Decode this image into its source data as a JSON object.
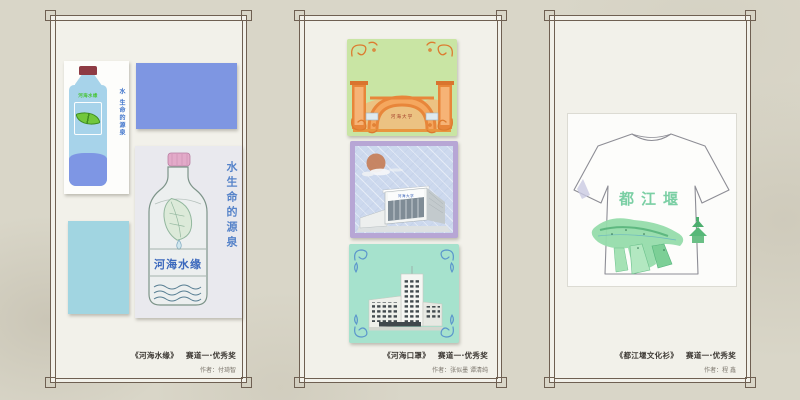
{
  "colors": {
    "page_background": "#d9d6c8",
    "frame_line": "#6f6052",
    "panel_background": "#f2f1ea",
    "cornflower_swatch": "#7e96e2",
    "cyan_swatch": "#a1d5e1",
    "mask1_background": "#c9e5a4",
    "mask1_accent": "#e8863a",
    "mask2_border": "#b7a6d5",
    "mask2_background": "#cdd9ee",
    "mask3_background": "#a6e2cd",
    "mask3_accent": "#5b96cc",
    "shirt_text_green": "#7bcfa4",
    "slogan_blue": "#3f74cc"
  },
  "panels": [
    {
      "name": "water-bottle-design",
      "caption": {
        "title": "《河海水缘》",
        "award": "赛道一·优秀奖",
        "author": "作者：付琦智"
      },
      "small_bottle": {
        "brand": "河海水缘",
        "slogan": "水 生命的源泉"
      },
      "big_bottle": {
        "brand": "河海水缘",
        "slogan": "水生命的源泉"
      }
    },
    {
      "name": "mask-design",
      "caption": {
        "title": "《河海口罩》",
        "award": "赛道一·优秀奖",
        "author": "作者：张似墨 谭清纯"
      },
      "cards": [
        {
          "label": "河海大学",
          "background": "#c9e5a4"
        },
        {
          "label": "河海大学",
          "background": "#cdd9ee"
        },
        {
          "label": "",
          "background": "#a6e2cd"
        }
      ]
    },
    {
      "name": "tshirt-design",
      "caption": {
        "title": "《都江堰文化衫》",
        "award": "赛道一·优秀奖",
        "author": "作者：程 鑫"
      },
      "shirt_text": "都江堰"
    }
  ]
}
